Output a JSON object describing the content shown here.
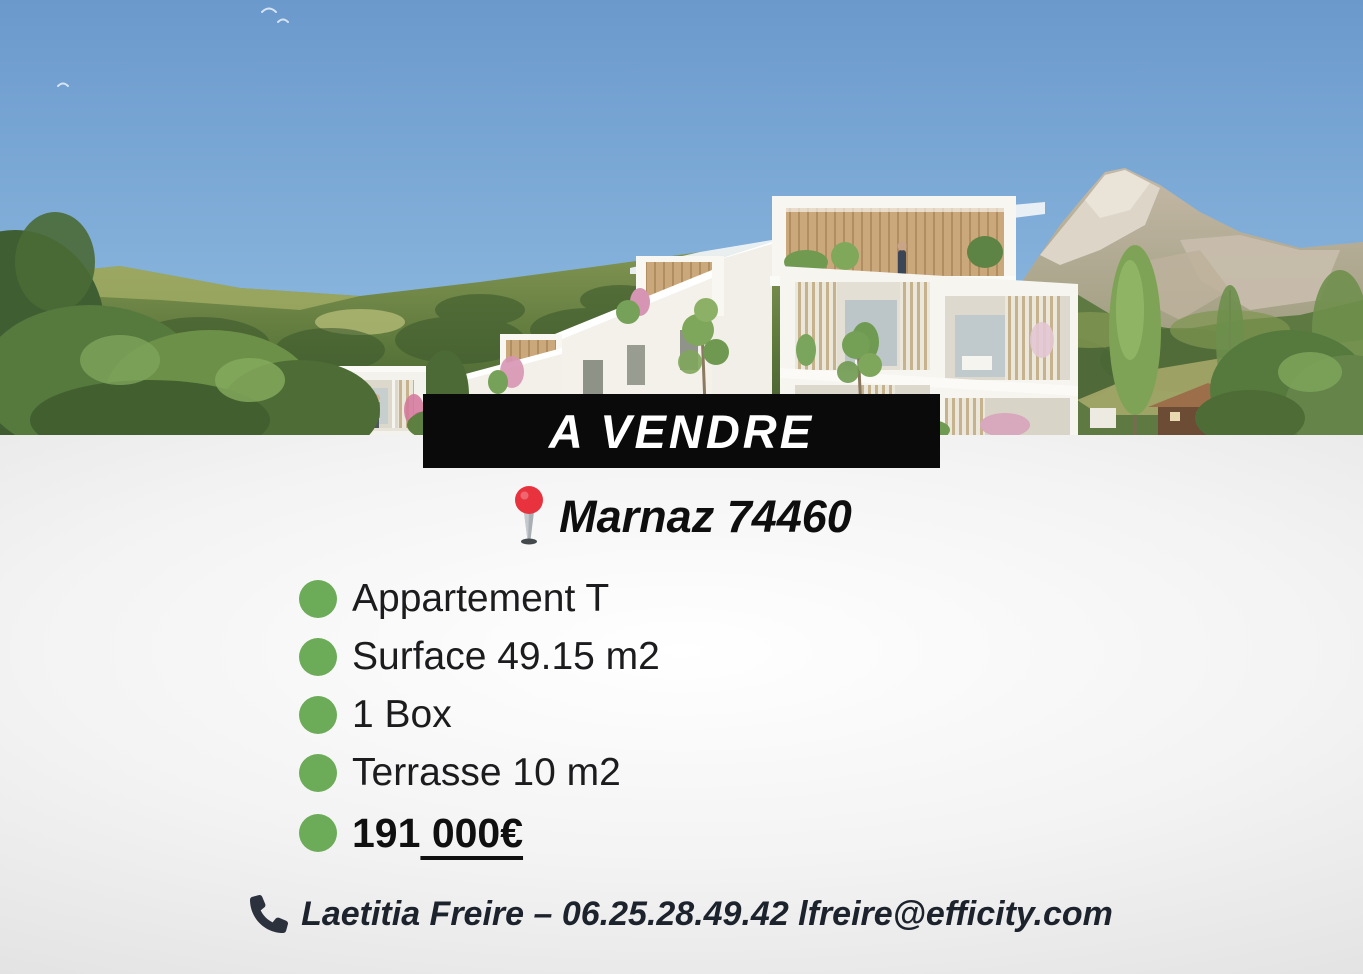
{
  "listing": {
    "banner_label": "A VENDRE",
    "location": "Marnaz 74460",
    "features": [
      "Appartement T",
      "Surface 49.15 m2",
      "1 Box",
      "Terrasse 10 m2"
    ],
    "price": {
      "full": "191 000€",
      "prefix": "191",
      "underlined_suffix": " 000€"
    },
    "contact": "Laetitia Freire – 06.25.28.49.42 lfreire@efficity.com"
  },
  "icons": {
    "location": "round-pushpin",
    "contact": "phone-handset",
    "feature_bullet": "green-dot"
  },
  "colors": {
    "banner_bg": "#0a0a0a",
    "banner_text": "#ffffff",
    "bullet_green": "#6cab58",
    "pin_red": "#e8333f",
    "body_text": "#1c1c1e",
    "contact_text": "#1d232d",
    "sky_top": "#6b99cc",
    "sky_bottom": "#9ec9e6"
  }
}
